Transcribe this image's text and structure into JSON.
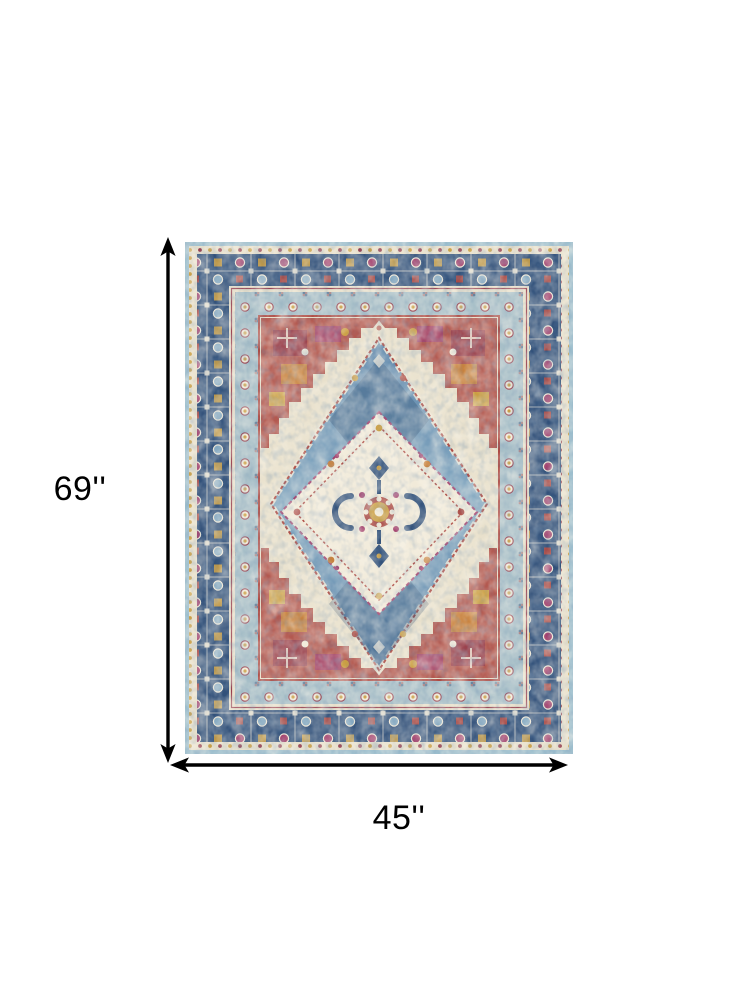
{
  "page": {
    "background": "#ffffff"
  },
  "rug": {
    "alt": "Vintage oriental medallion area rug in blue, ivory, red and orange",
    "palette": {
      "edge": "#9dbfce",
      "navy": "#32517a",
      "navyDeep": "#2c4568",
      "borderLight": "#a7bfc8",
      "cream": "#e8e0cb",
      "creamBright": "#f1ead9",
      "fieldBlue": "#5e87ac",
      "fieldBlueLight": "#87abc3",
      "red": "#ad4a43",
      "crimson": "#973f4e",
      "magenta": "#a13f6c",
      "orange": "#c8813d",
      "gold": "#cb9e41",
      "ink": "#000000"
    }
  },
  "dimensions": {
    "height_label": "69''",
    "width_label": "45''"
  }
}
